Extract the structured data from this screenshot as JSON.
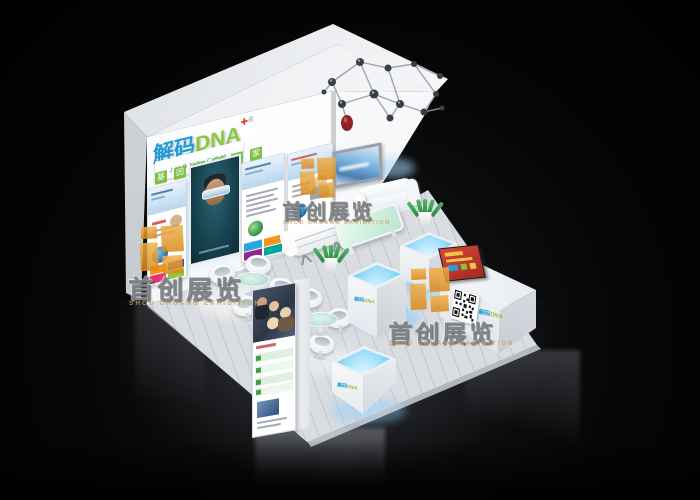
{
  "branding": {
    "logo_cn": "解码",
    "logo_en": "DNA",
    "registered_mark": "®",
    "medical_cross_icon": "✚",
    "domain": "JMDNA.COM",
    "tagline_chars": [
      "基",
      "因",
      "检",
      "测",
      "专",
      "家"
    ]
  },
  "watermark": {
    "title": "首创展览",
    "subtitle": "SHOU CHUANG EXHIBITION"
  },
  "colors": {
    "brand_blue": "#29a8e0",
    "brand_green": "#8dc63f",
    "accent_red": "#d6453a",
    "watermark_orange": "#e9a23b",
    "glow_cyan": "#7fd4f7",
    "booth_white": "#f4f6f8",
    "background": "#000000"
  }
}
